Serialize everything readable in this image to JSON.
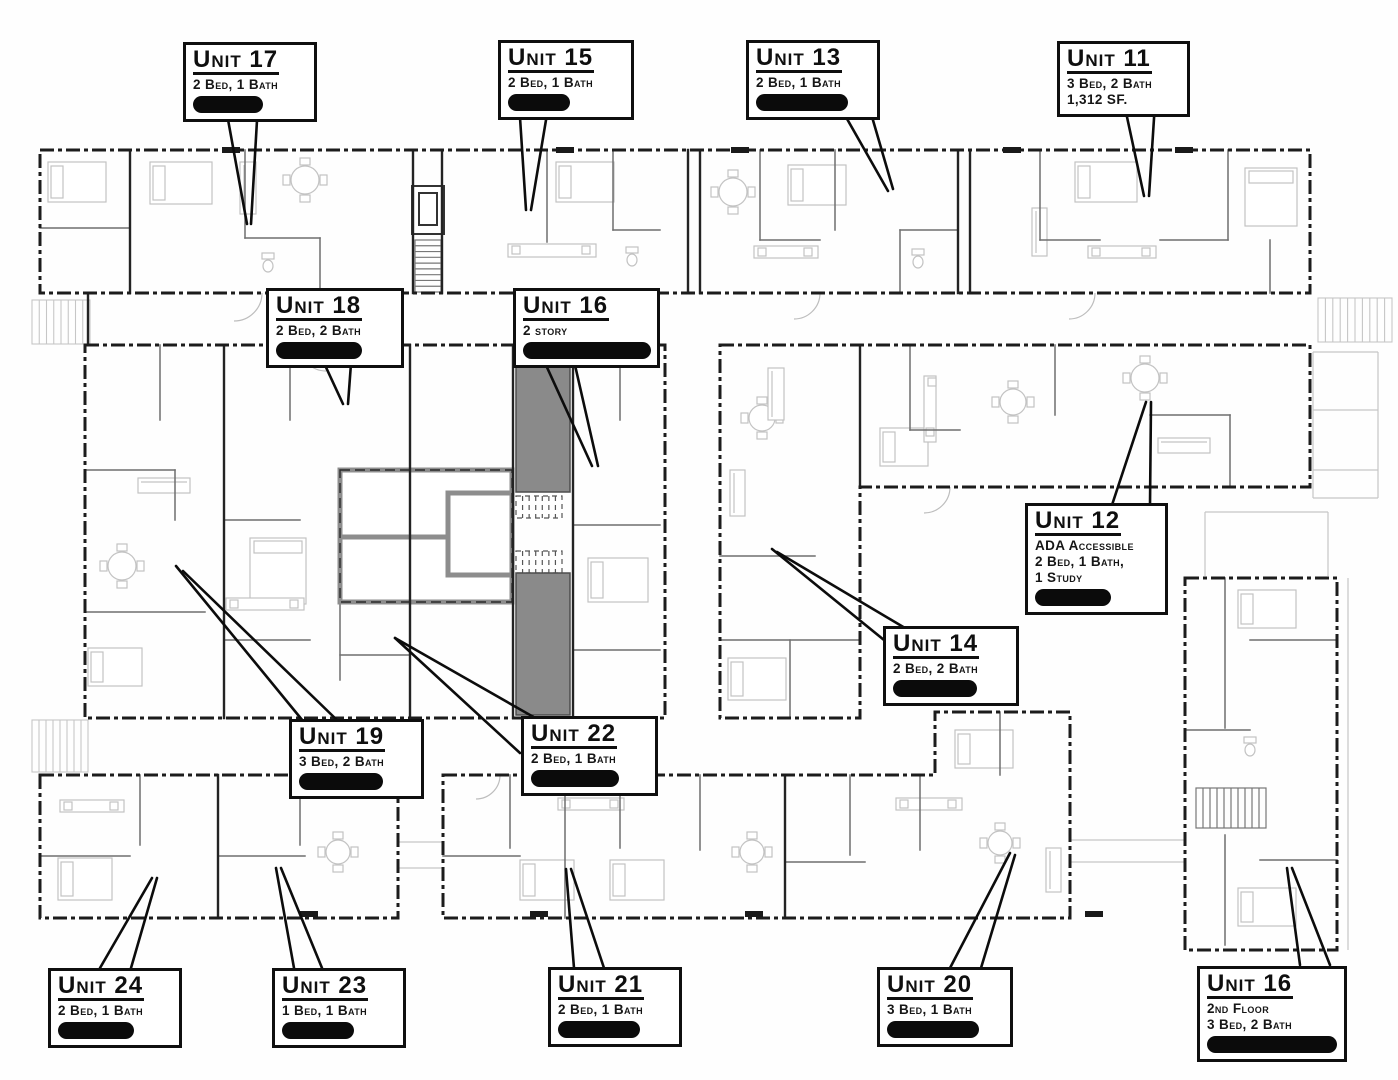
{
  "drawing": {
    "kind_label": "apartment building floor plan",
    "colors": {
      "walls": "#1c1c1c",
      "label_border": "#0f0f0f",
      "stairwell_fill": "#8a8a8a",
      "redaction": "#0b0b0b",
      "light_detail": "#c6c6c6"
    }
  },
  "units": [
    {
      "id": "unit-17",
      "title": "Unit 17",
      "lines": [
        "2 Bed, 1 Bath"
      ],
      "redacted": true
    },
    {
      "id": "unit-15",
      "title": "Unit 15",
      "lines": [
        "2 Bed, 1 Bath"
      ],
      "redacted": true
    },
    {
      "id": "unit-13",
      "title": "Unit 13",
      "lines": [
        "2 Bed, 1 Bath"
      ],
      "redacted": true
    },
    {
      "id": "unit-11",
      "title": "Unit 11",
      "lines": [
        "3 Bed, 2 Bath",
        "1,312 SF."
      ],
      "redacted": false
    },
    {
      "id": "unit-18",
      "title": "Unit 18",
      "lines": [
        "2 Bed, 2 Bath"
      ],
      "redacted": true
    },
    {
      "id": "unit-16-main",
      "title": "Unit 16",
      "lines": [
        "2 story"
      ],
      "redacted": true
    },
    {
      "id": "unit-12",
      "title": "Unit 12",
      "lines": [
        "ADA Accessible",
        "2 Bed, 1 Bath,",
        "1 Study"
      ],
      "redacted": true
    },
    {
      "id": "unit-14",
      "title": "Unit 14",
      "lines": [
        "2 Bed, 2 Bath"
      ],
      "redacted": true
    },
    {
      "id": "unit-19",
      "title": "Unit 19",
      "lines": [
        "3 Bed, 2 Bath"
      ],
      "redacted": true
    },
    {
      "id": "unit-22",
      "title": "Unit 22",
      "lines": [
        "2 Bed, 1 Bath"
      ],
      "redacted": true
    },
    {
      "id": "unit-24",
      "title": "Unit 24",
      "lines": [
        "2 Bed, 1 Bath"
      ],
      "redacted": true
    },
    {
      "id": "unit-23",
      "title": "Unit 23",
      "lines": [
        "1 Bed, 1 Bath"
      ],
      "redacted": true
    },
    {
      "id": "unit-21",
      "title": "Unit 21",
      "lines": [
        "2 Bed, 1 Bath"
      ],
      "redacted": true
    },
    {
      "id": "unit-20",
      "title": "Unit 20",
      "lines": [
        "3 Bed, 1 Bath"
      ],
      "redacted": true
    },
    {
      "id": "unit-16-2nd",
      "title": "Unit 16",
      "lines": [
        "2nd Floor",
        "3 Bed, 2 Bath"
      ],
      "redacted": true
    }
  ]
}
